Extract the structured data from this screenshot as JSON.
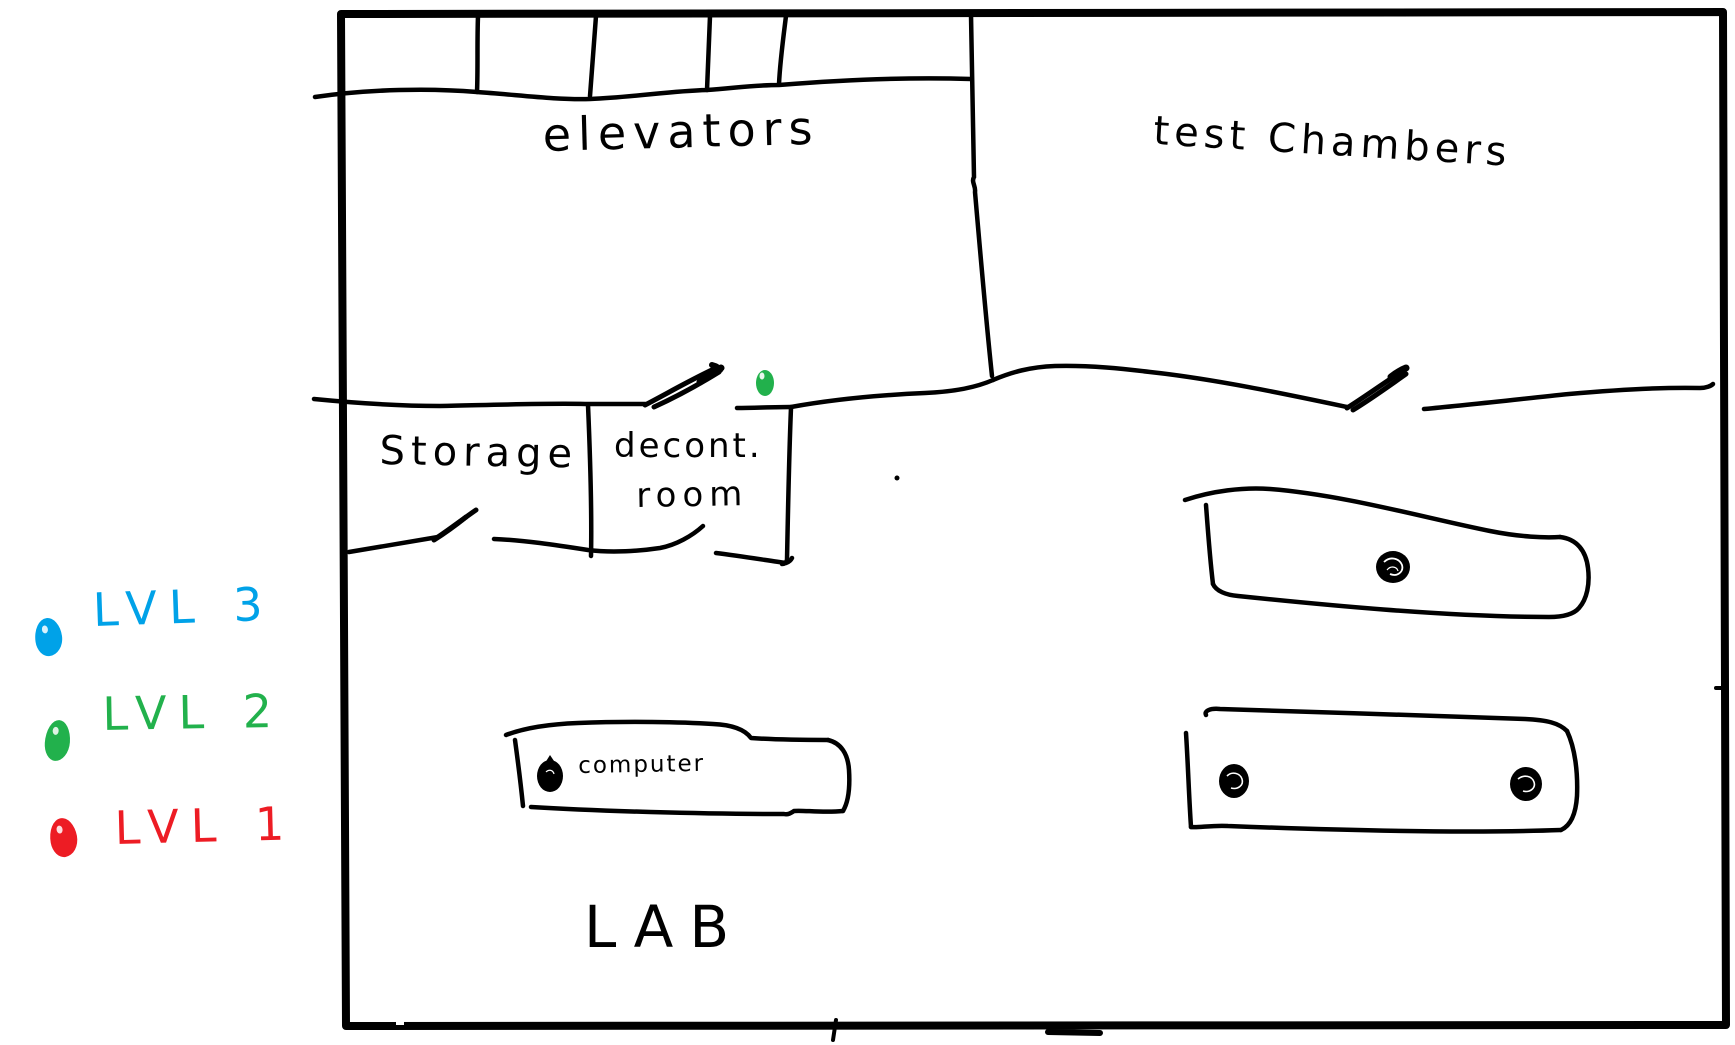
{
  "canvas": {
    "background": "#ffffff",
    "ink": "#000000"
  },
  "map": {
    "rooms": [
      {
        "id": "elevators",
        "label": "elevators"
      },
      {
        "id": "test-chambers",
        "label": "test Chambers"
      },
      {
        "id": "storage",
        "label": "Storage"
      },
      {
        "id": "decont-room",
        "label_line1": "decont.",
        "label_line2": "room"
      },
      {
        "id": "lab",
        "label": "LAB"
      }
    ],
    "objects": [
      {
        "id": "computer-desk",
        "label": "computer"
      }
    ]
  },
  "legend": {
    "items": [
      {
        "label": "LVL 3",
        "color": "#00a2e8"
      },
      {
        "label": "LVL 2",
        "color": "#22b14c"
      },
      {
        "label": "LVL 1",
        "color": "#ed1c24"
      }
    ]
  },
  "markers": {
    "corridor_dot": {
      "level": "LVL 2",
      "color": "#22b14c"
    }
  }
}
